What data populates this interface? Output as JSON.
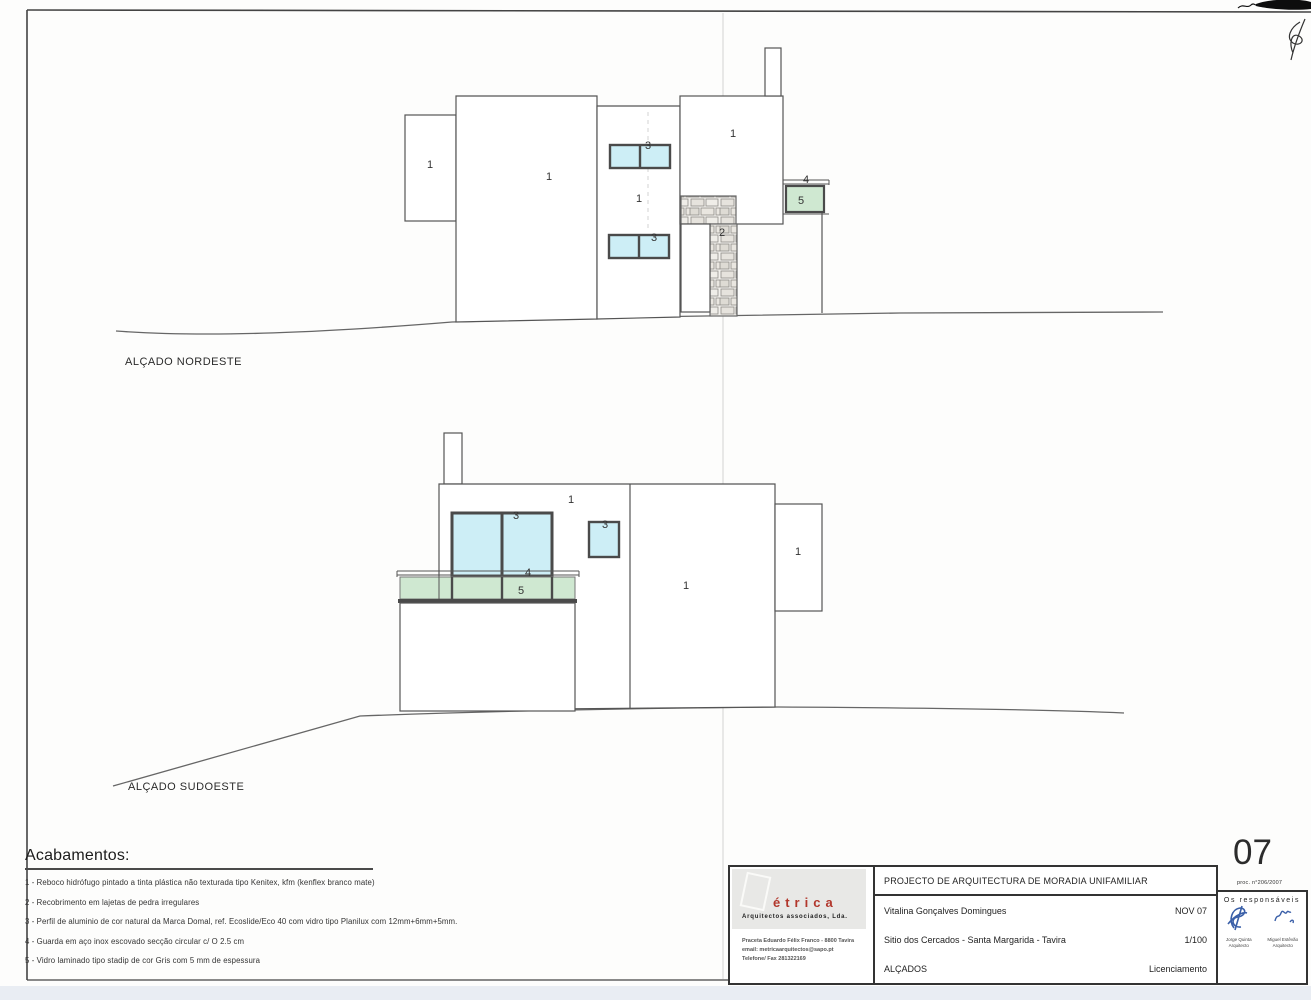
{
  "page": {
    "sheet_number": "07",
    "process_number": "proc. n°206/2007"
  },
  "elevations": {
    "nordeste": {
      "title": "ALÇADO NORDESTE",
      "labels": {
        "left_volume": "1",
        "main_volume": "1",
        "tower": "1",
        "right_volume": "1",
        "window_upper": "3",
        "window_lower": "3",
        "stone_pillar": "2",
        "handrail": "4",
        "glass_panel": "5"
      }
    },
    "sudoeste": {
      "title": "ALÇADO SUDOESTE",
      "labels": {
        "wall": "1",
        "right_wall": "1",
        "side_volume": "1",
        "window_large": "3",
        "window_small": "3",
        "handrail": "4",
        "glass_panel": "5"
      }
    }
  },
  "legend": {
    "title": "Acabamentos:",
    "items": [
      "1 - Reboco hidrófugo pintado a tinta plástica não texturada tipo Kenitex, kfm (kenflex branco mate)",
      "2 - Recobrimento em lajetas de pedra irregulares",
      "3 - Perfil de aluminio de cor natural da Marca Domal, ref. Ecoslide/Eco 40 com vidro tipo Planilux com 12mm+6mm+5mm.",
      "4 - Guarda em aço inox escovado secção circular c/ O 2.5 cm",
      "5 - Vidro laminado tipo stadip de cor Gris com 5 mm de espessura"
    ]
  },
  "title_block": {
    "firm": {
      "name": "étrica",
      "subtitle": "Arquitectos associados, Lda.",
      "address": "Praceta Eduardo Félix Franco - 8800 Tavira",
      "email": "email: metricaarquitectos@sapo.pt",
      "phone": "Telefone/ Fax  281322169"
    },
    "project_title": "PROJECTO DE ARQUITECTURA DE MORADIA UNIFAMILIAR",
    "client": "Vitalina Gonçalves Domingues",
    "date": "NOV 07",
    "location": "Sitio dos Cercados - Santa Margarida - Tavira",
    "scale": "1/100",
    "sheet_title": "ALÇADOS",
    "phase": "Licenciamento",
    "responsibles": {
      "heading": "Os responsáveis",
      "signers": [
        {
          "name": "Jorge Quinta",
          "role": "Arquitecto"
        },
        {
          "name": "Miguel Estêvão",
          "role": "Arquitecto"
        }
      ]
    }
  },
  "colors": {
    "glass_blue": "#cdeef6",
    "glass_green": "#cfe8d1",
    "logo_red": "#b2372c",
    "signature_blue": "#3a5fa8",
    "line_dark": "#555555"
  }
}
